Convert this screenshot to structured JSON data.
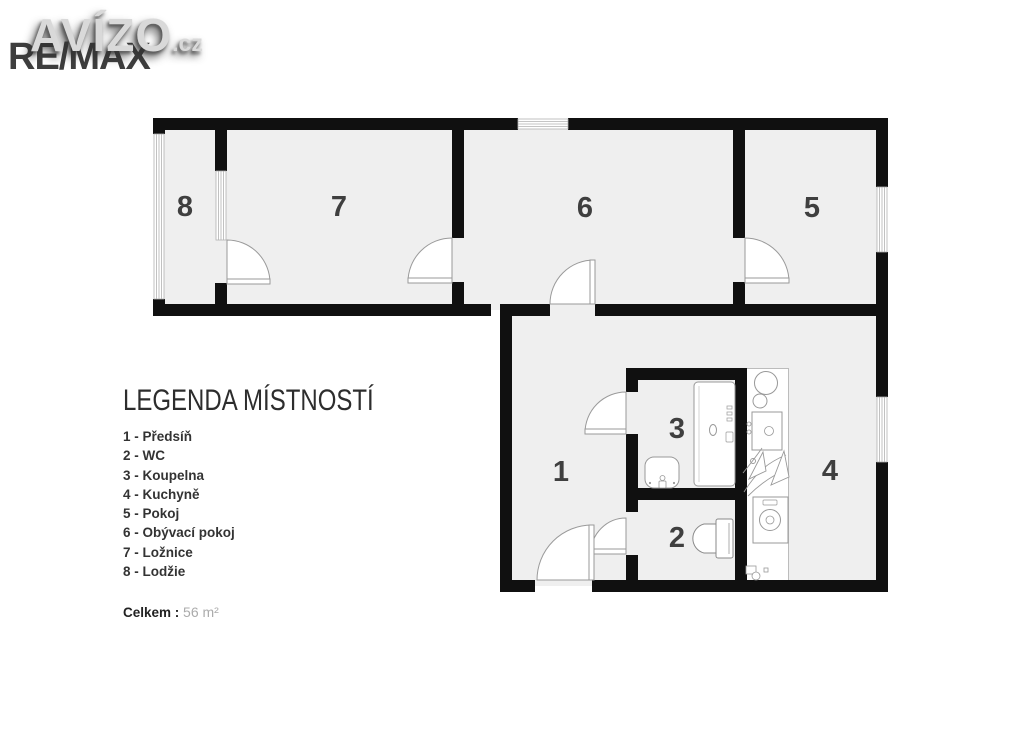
{
  "logo": {
    "brand": "AVÍZO",
    "tld": ".cz",
    "agency": "RE/MAX"
  },
  "plan": {
    "room_labels": [
      "1",
      "2",
      "3",
      "4",
      "5",
      "6",
      "7",
      "8"
    ]
  },
  "legend": {
    "title": "LEGENDA MÍSTNOSTÍ",
    "items": [
      "1 - Předsíň",
      "2 - WC",
      "3 - Koupelna",
      "4 - Kuchyně",
      "5 - Pokoj",
      "6 - Obývací pokoj",
      "7 - Ložnice",
      "8 - Lodžie"
    ],
    "total_label": "Celkem :",
    "total_value": "56 m²"
  }
}
